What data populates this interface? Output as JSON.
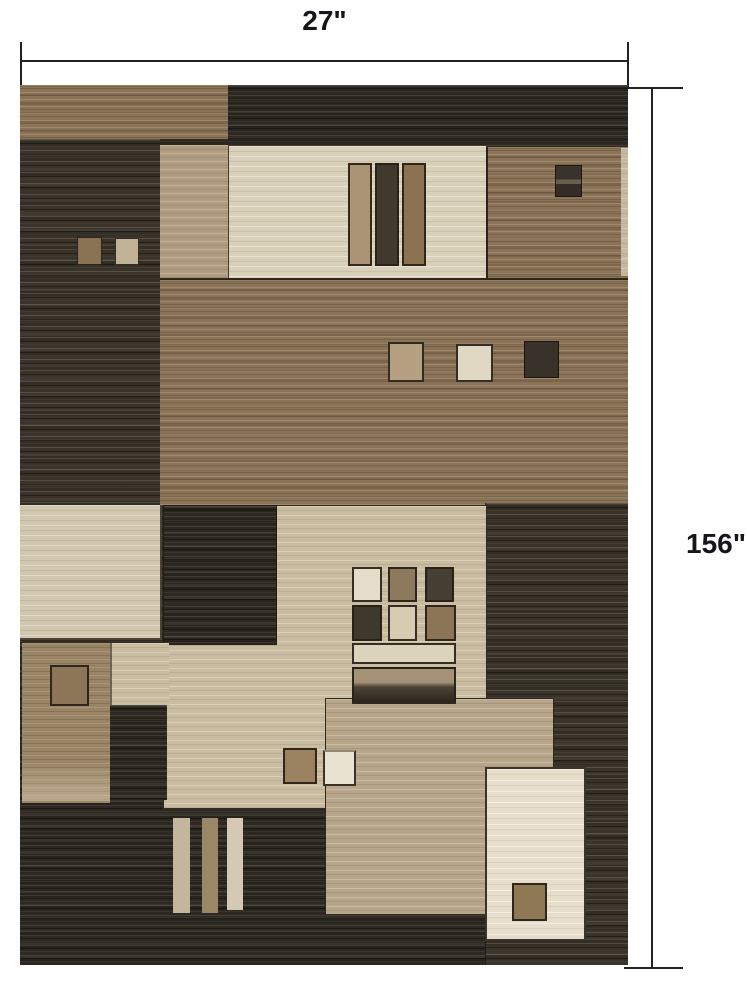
{
  "figure": {
    "title": "Rug dimension diagram",
    "subject": "Geometric patchwork area rug in browns, beiges and charcoal"
  },
  "dimensions": {
    "width_label": "27\"",
    "height_label": "156\""
  },
  "palette": {
    "page_bg": "#ffffff",
    "dim_line": "#222222",
    "label_text": "#15161b",
    "dark": "#2d2922",
    "dark2": "#39332a",
    "brown": "#8a7356",
    "brown2": "#9a8466",
    "tan": "#b09d81",
    "tan2": "#b7a689",
    "beige": "#c9bca1",
    "cream": "#d9d0ba",
    "cream2": "#d1c6ae",
    "cream3": "#e6decb"
  }
}
